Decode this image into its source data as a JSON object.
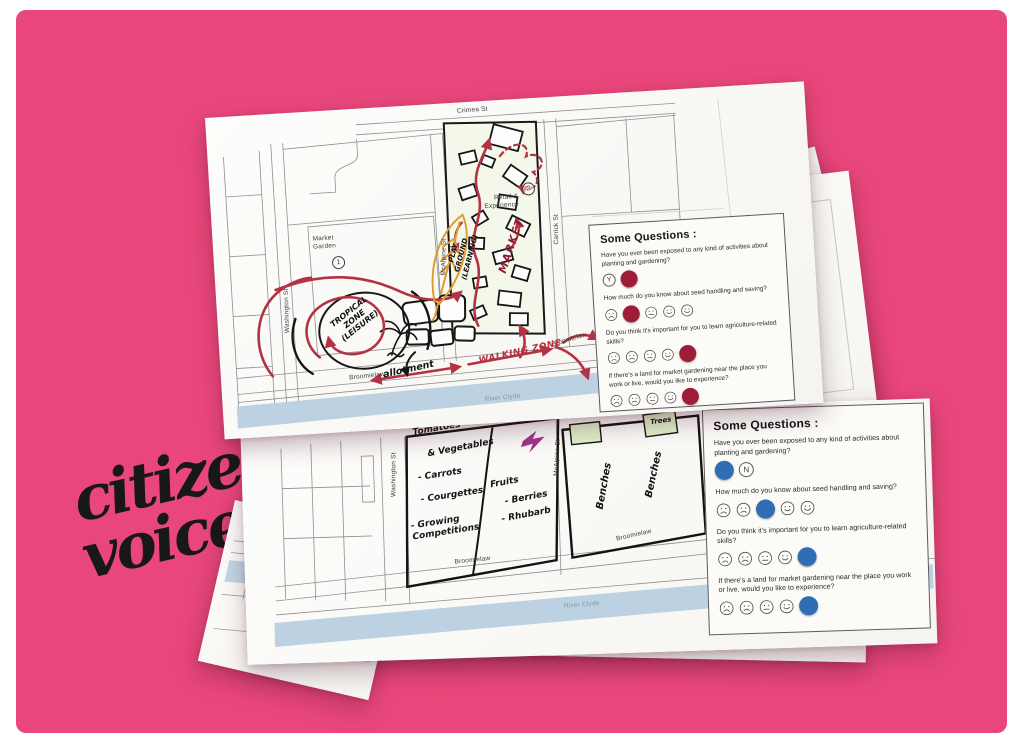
{
  "photo": {
    "caption_line1": "citizen",
    "caption_line2": "voice"
  },
  "palette": {
    "background_pink": "#E9477B",
    "frame_white": "#FFFFFF",
    "paper_white": "#FCFBF8",
    "marker_red": "#B43343",
    "dot_red": "#9E1C38",
    "dot_blue": "#2F6EB5",
    "river_blue": "#BCD1E1",
    "river_text": "#7E98AC",
    "leaf_orange": "#DE9C33",
    "bolt_purple": "#A23390",
    "sticky_green": "#DEEFC8",
    "ink_black": "#141414",
    "map_line_gray": "#8F8F8F"
  },
  "sheet_top_map": {
    "streets": {
      "crimea": "Crimea St",
      "washington": "Washington St",
      "mcalpine": "McAlpine St",
      "carrick": "Carrick St",
      "broomielaw_left": "Broomielaw",
      "broomielaw_right": "Broomielaw",
      "river": "River Clyde"
    },
    "printed": {
      "market_line1": "Market",
      "market_line2": "Garden",
      "num1": "1",
      "retail_line1": "Retail &",
      "retail_line2": "Experience",
      "num2": "2"
    },
    "handwritten": {
      "tropical_line1": "TROPICAL",
      "tropical_line2": "ZONE",
      "tropical_line3": "(LEISURE)",
      "allotment": "allotment",
      "walking_zone": "WALKING ZONE",
      "playground_line1": "PLAY",
      "playground_line2": "GROUND",
      "playground_line3": "(LEARNING)",
      "market": "MARKET"
    }
  },
  "sheet_bottom_map": {
    "streets": {
      "washington": "Washington St",
      "mcalpine": "McAlpine St",
      "broomielaw_bottom": "Broomielaw",
      "broomielaw_right": "Broomielaw",
      "river": "River Clyde"
    },
    "handwritten": {
      "veg_line1": "Tomatoes",
      "veg_line2": "& Vegetables",
      "veg_items": [
        "- Carrots",
        "- Courgettes",
        "- Growing Competitions"
      ],
      "fruit_title": "Fruits",
      "fruit_items": [
        "- Berries",
        "- Rhubarb"
      ],
      "benches_left": "Benches",
      "benches_right": "Benches",
      "trees": "Trees"
    }
  },
  "questions_panel": {
    "title": "Some Questions :",
    "yn_labels": [
      "Y",
      "N"
    ],
    "questions": [
      {
        "text": "Have you ever been exposed to any kind of activities about planting and gardening?",
        "scale": "yn"
      },
      {
        "text": "How much do you know about seed handling and saving?",
        "scale": "faces"
      },
      {
        "text": "Do you think it's important for you to learn agriculture-related skills?",
        "scale": "faces"
      },
      {
        "text": "If there's a land for market gardening near the place you work or live, would you like to experience?",
        "scale": "faces"
      }
    ]
  },
  "responses": {
    "sheet_top": {
      "dot_color": "#9E1C38",
      "answers": [
        {
          "selected": "N"
        },
        {
          "selected": 2
        },
        {
          "selected": 5
        },
        {
          "selected": 5
        }
      ]
    },
    "sheet_middle": {
      "dot_color": "#2F6EB5",
      "answers": [
        {
          "selected": "Y"
        },
        {
          "selected": 3
        },
        {
          "selected": 5
        },
        {
          "selected": 5
        }
      ]
    }
  }
}
